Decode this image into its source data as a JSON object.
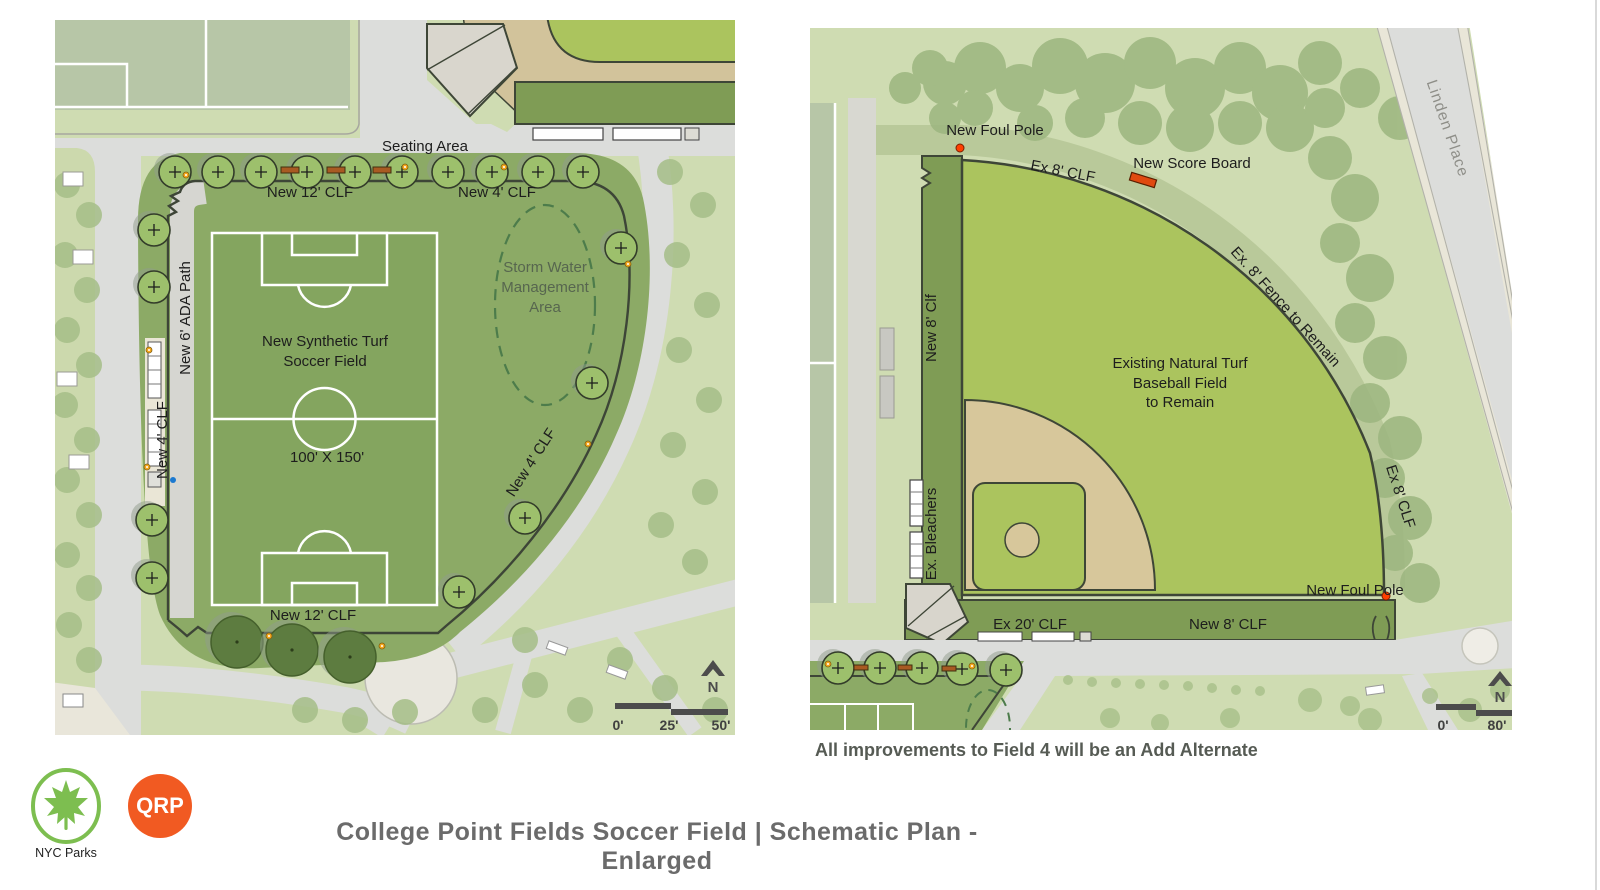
{
  "page": {
    "title": "College Point Fields Soccer Field  |  Schematic Plan - Enlarged",
    "note": "All improvements to Field 4 will be an Add Alternate"
  },
  "logos": {
    "nyc_parks_label": "NYC Parks",
    "qrp_label": "QRP",
    "qrp_color": "#f15a22",
    "parks_green": "#7dbe50"
  },
  "left_plan": {
    "labels": {
      "seating_area": "Seating Area",
      "new_12_clf_top": "New 12' CLF",
      "new_4_clf_top": "New 4' CLF",
      "new_6_ada_path": "New 6' ADA Path",
      "new_4_clf_left": "New 4' CLF",
      "field_line1": "New Synthetic Turf",
      "field_line2": "Soccer Field",
      "field_dims": "100' X 150'",
      "storm_line1": "Storm Water",
      "storm_line2": "Management",
      "storm_line3": "Area",
      "new_4_clf_right": "New 4' CLF",
      "new_12_clf_bottom": "New 12' CLF"
    },
    "scale": {
      "zero": "0'",
      "mid": "25'",
      "end": "50'",
      "north": "N"
    }
  },
  "right_plan": {
    "labels": {
      "new_foul_pole_top": "New Foul Pole",
      "ex_8_clf_top": "Ex 8' CLF",
      "new_score_board": "New Score Board",
      "ex_8_fence": "Ex. 8' Fence to Remain",
      "linden_place": "Linden Place",
      "new_8_clf_left": "New 8' Clf",
      "ex_bleachers": "Ex. Bleachers",
      "field_line1": "Existing Natural Turf",
      "field_line2": "Baseball Field",
      "field_line3": "to Remain",
      "ex_8_clf_right": "Ex 8' CLF",
      "new_foul_pole_bottom": "New Foul Pole",
      "ex_20_clf": "Ex 20' CLF",
      "new_8_clf_bottom": "New 8' CLF"
    },
    "scale": {
      "zero": "0'",
      "end": "80'",
      "north": "N"
    }
  },
  "colors": {
    "road": "#dcdddb",
    "park_light": "#cfdcb2",
    "site_green": "#8caa66",
    "bright_field": "#abc45e",
    "olive_band": "#7f9c55",
    "sage": "#b7c6a7",
    "tan": "#d7c79b",
    "fence": "#3e4637",
    "tree": "#9dc06c",
    "tree_dark": "#5d7c40",
    "accent_orange": "#ff4000"
  }
}
